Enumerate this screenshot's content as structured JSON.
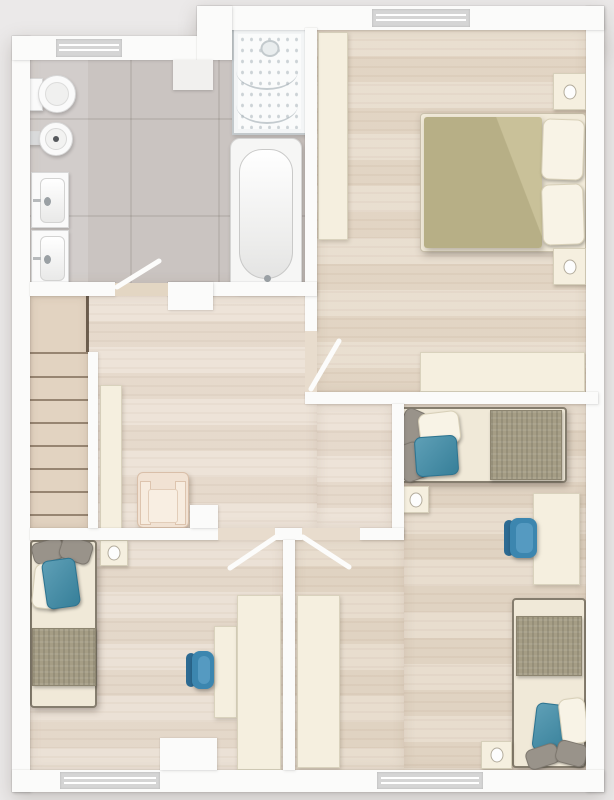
{
  "floorplan": {
    "title": "Upper floor plan",
    "style": "rendered top-down architectural plan, no text labels",
    "rooms": [
      {
        "id": "bathroom",
        "label": "Bathroom",
        "floor_finish": "grey tile",
        "fixtures": [
          "toilet",
          "round washbasin",
          "vanity basin",
          "vanity basin",
          "shower enclosure",
          "bathtub"
        ],
        "windows": 1,
        "doors": 1
      },
      {
        "id": "master-bedroom",
        "label": "Master bedroom",
        "floor_finish": "light wood",
        "furniture": [
          "double bed with olive duvet",
          "pillow",
          "pillow",
          "nightstand",
          "nightstand",
          "tall wardrobe",
          "low wardrobe"
        ],
        "windows": 1,
        "doors": 1
      },
      {
        "id": "landing",
        "label": "Landing / hallway",
        "floor_finish": "light wood",
        "furniture": [
          "staircase with 8 treads and landing",
          "armchair",
          "console shelf"
        ],
        "windows": 0,
        "doors": 0
      },
      {
        "id": "bedroom-east",
        "label": "Bedroom (right, L-shaped)",
        "floor_finish": "light wood",
        "furniture": [
          "single bed with teal pillow",
          "single bed with teal pillow",
          "nightstand",
          "nightstand",
          "desk",
          "blue office chair",
          "wardrobe"
        ],
        "windows": 1,
        "doors": 1
      },
      {
        "id": "bedroom-southwest",
        "label": "Bedroom (bottom left)",
        "floor_finish": "light wood",
        "furniture": [
          "single bed with teal pillow",
          "nightstand",
          "desk",
          "blue office chair",
          "wardrobe"
        ],
        "windows": 1,
        "doors": 1
      }
    ],
    "totals": {
      "windows": 4,
      "door_swings": 4,
      "beds": 4,
      "office_chairs": 2,
      "nightstands": 5
    },
    "palette": {
      "background": "#ebe9e9",
      "wall": "#fbfbfa",
      "tile": "#cac4c1",
      "wood": "#e7dbcb",
      "furniture_cream": "#f5efdf",
      "pillow_teal": "#3b8aa6",
      "chair_blue": "#3c86af",
      "duvet_olive": "#b7af86",
      "blanket_grey": "#a59d85"
    }
  }
}
